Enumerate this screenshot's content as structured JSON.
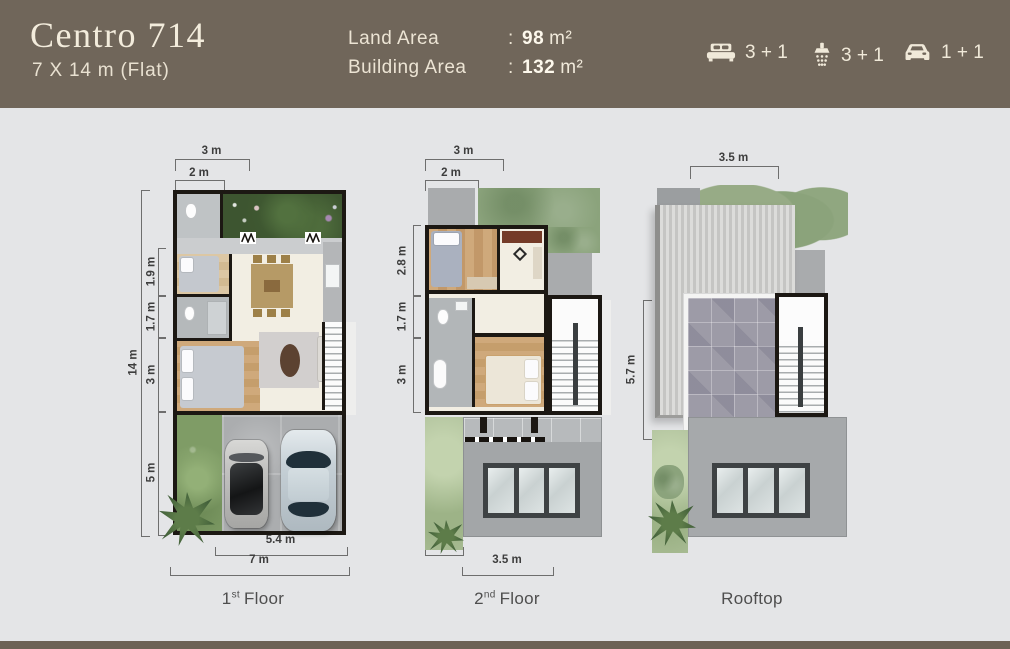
{
  "header": {
    "title": "Centro 714",
    "subtitle": "7 X 14 m (Flat)",
    "specs": [
      {
        "label": "Land Area",
        "separator": ":",
        "value": "98",
        "unit": "m²"
      },
      {
        "label": "Building Area",
        "separator": ":",
        "value": "132",
        "unit": "m²"
      }
    ],
    "amenities": [
      {
        "icon": "bed-icon",
        "count": "3 + 1"
      },
      {
        "icon": "shower-icon",
        "count": "3 + 1"
      },
      {
        "icon": "car-icon",
        "count": "1 + 1"
      }
    ]
  },
  "plans": [
    {
      "floor_label": {
        "num": "1",
        "sup": "st",
        "rest": "Floor"
      },
      "dims": {
        "top": [
          "3 m",
          "2 m"
        ],
        "left_total": "14 m",
        "left": [
          "1.9 m",
          "1.7 m",
          "3 m",
          "5 m"
        ],
        "bottom": [
          "5.4 m",
          "7 m"
        ]
      }
    },
    {
      "floor_label": {
        "num": "2",
        "sup": "nd",
        "rest": "Floor"
      },
      "dims": {
        "top": [
          "3 m",
          "2 m"
        ],
        "left": [
          "2.8 m",
          "1.7 m",
          "3 m"
        ],
        "bottom": [
          "1.5 m",
          "3.5 m"
        ]
      }
    },
    {
      "floor_label": {
        "num": "",
        "sup": "",
        "rest": "Rooftop"
      },
      "dims": {
        "top": [
          "3.5 m"
        ],
        "left": [
          "5.7 m"
        ]
      }
    }
  ],
  "colors": {
    "header_bg": "#70665a",
    "page_bg": "#e4e5e7",
    "text_cream": "#f2ebdb",
    "wall_black": "#1c1813",
    "garden_green": "#3d5530",
    "lawn_green": "#7f9c66",
    "sage_green": "#8ba37c",
    "concrete_gray": "#abadaf",
    "wood_tan": "#c9a26e",
    "dim_text": "#3d3d3d"
  }
}
